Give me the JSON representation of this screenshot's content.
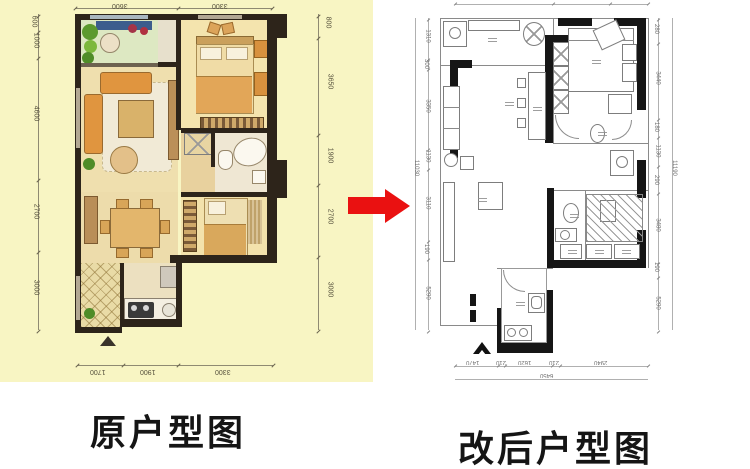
{
  "captions": {
    "left": "原户型图",
    "right": "改后户型图"
  },
  "arrow": {
    "direction": "right",
    "color": "#ea1111"
  },
  "left_plan": {
    "bg_color": "#f8f5c3",
    "dims_top": [
      "3600",
      "3300"
    ],
    "dims_bottom": [
      "1700",
      "1900",
      "3300"
    ],
    "dims_left": [
      "600",
      "1000",
      "4600",
      "2700",
      "3000"
    ],
    "dims_right": [
      "800",
      "3650",
      "1900",
      "2700",
      "3000"
    ]
  },
  "right_plan": {
    "dims_left": [
      "1310",
      "300",
      "3350",
      "1130",
      "3110",
      "190",
      "5290"
    ],
    "dims_left_total": "11030",
    "dims_right": [
      "280",
      "3440",
      "180",
      "1130",
      "290",
      "3480",
      "190",
      "5290"
    ],
    "dims_right_total": "11190",
    "dims_bottom": [
      "1470",
      "210",
      "1620",
      "210",
      "2940"
    ],
    "dims_bottom_total": "6450"
  }
}
